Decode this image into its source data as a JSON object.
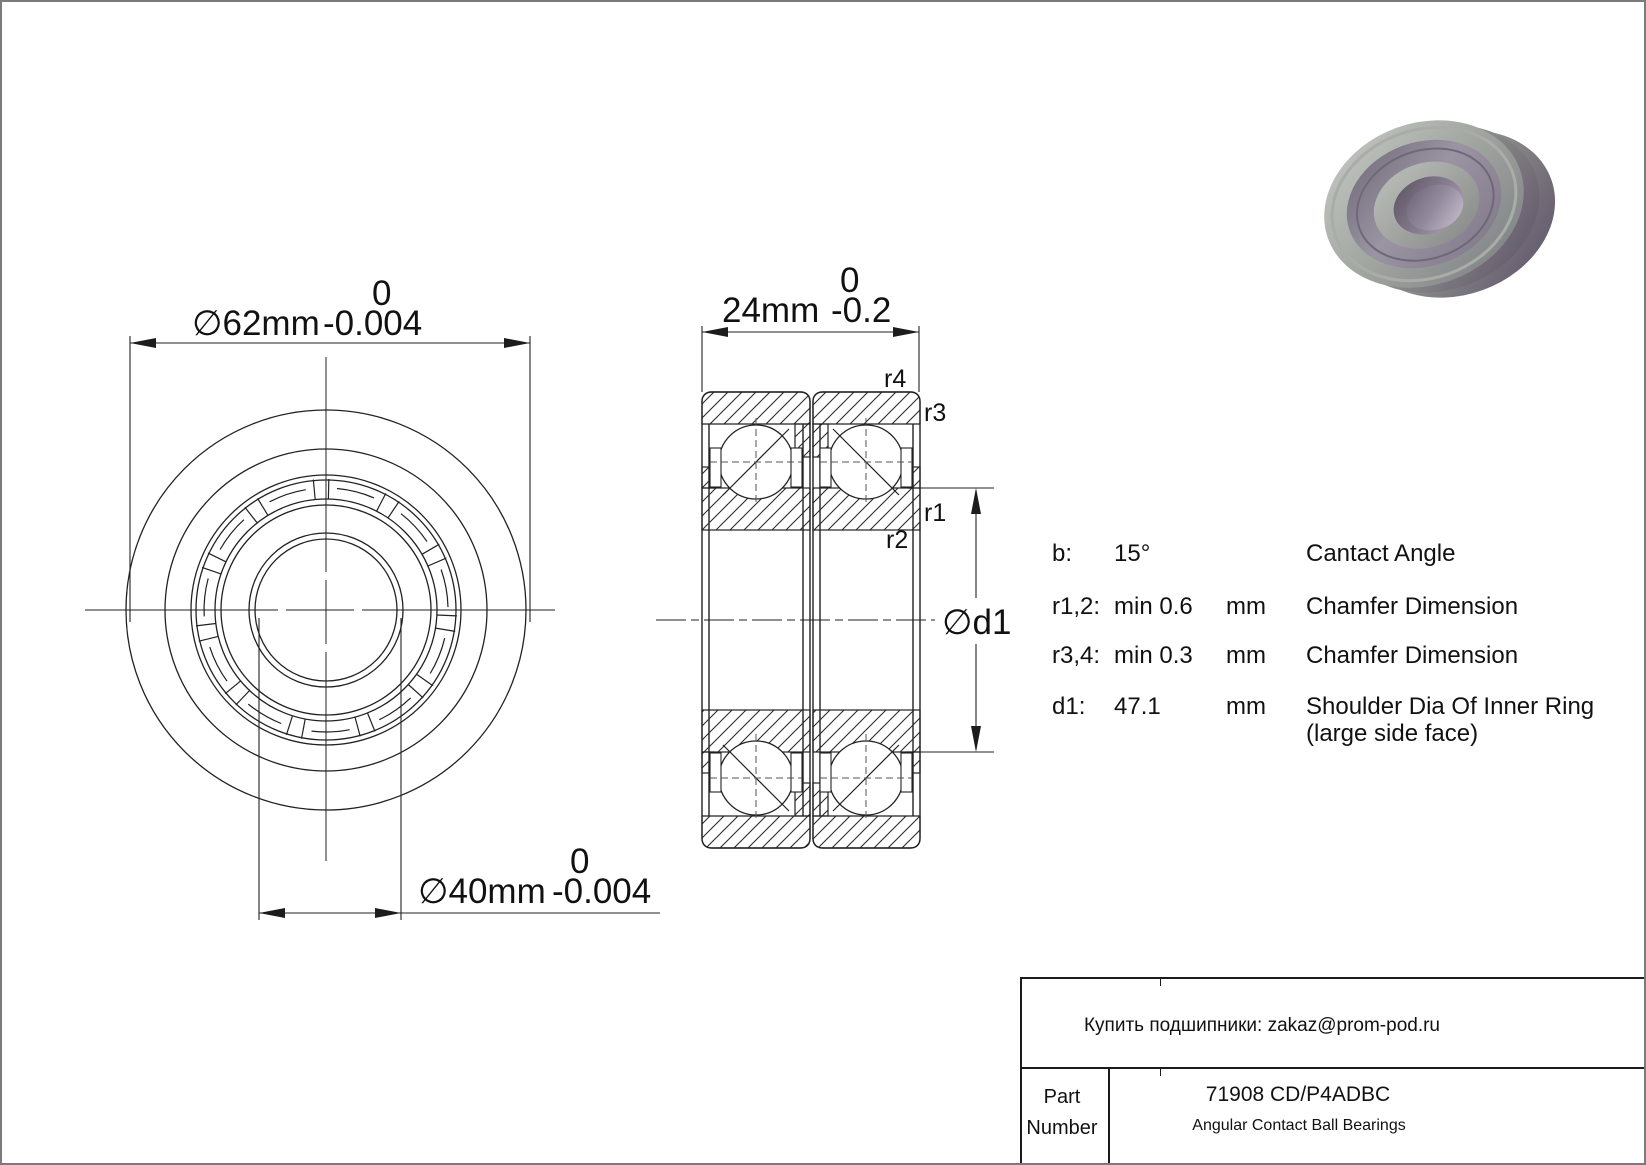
{
  "front_view": {
    "dim_outer": {
      "label": "∅62mm",
      "tol_top": "0",
      "tol_bottom": "-0.004"
    },
    "dim_bore": {
      "label": "∅40mm",
      "tol_top": "0",
      "tol_bottom": "-0.004"
    }
  },
  "section_view": {
    "dim_width": {
      "label": "24mm",
      "tol_top": "0",
      "tol_bottom": "-0.2"
    },
    "labels": {
      "r1": "r1",
      "r2": "r2",
      "r3": "r3",
      "r4": "r4",
      "d1": "∅d1"
    }
  },
  "specs": {
    "rows": [
      {
        "key": "b:",
        "value": "15°",
        "unit": "",
        "desc": "Cantact Angle",
        "desc2": ""
      },
      {
        "key": "r1,2:",
        "value": "min 0.6",
        "unit": "mm",
        "desc": "Chamfer Dimension",
        "desc2": ""
      },
      {
        "key": "r3,4:",
        "value": "min 0.3",
        "unit": "mm",
        "desc": "Chamfer Dimension",
        "desc2": ""
      },
      {
        "key": "d1:",
        "value": "47.1",
        "unit": "mm",
        "desc": "Shoulder Dia Of Inner Ring",
        "desc2": "(large side face)"
      }
    ]
  },
  "title_block": {
    "contact": "Купить подшипники: zakaz@prom-pod.ru",
    "part_label_line1": "Part",
    "part_label_line2": "Number",
    "part_number": "71908 CD/P4ADBC",
    "part_type": "Angular Contact Ball Bearings"
  },
  "colors": {
    "line": "#1c1c1c",
    "page_border": "#7b7b7b",
    "render_gray": "#9a9e99",
    "render_purple": "#7d7083"
  }
}
